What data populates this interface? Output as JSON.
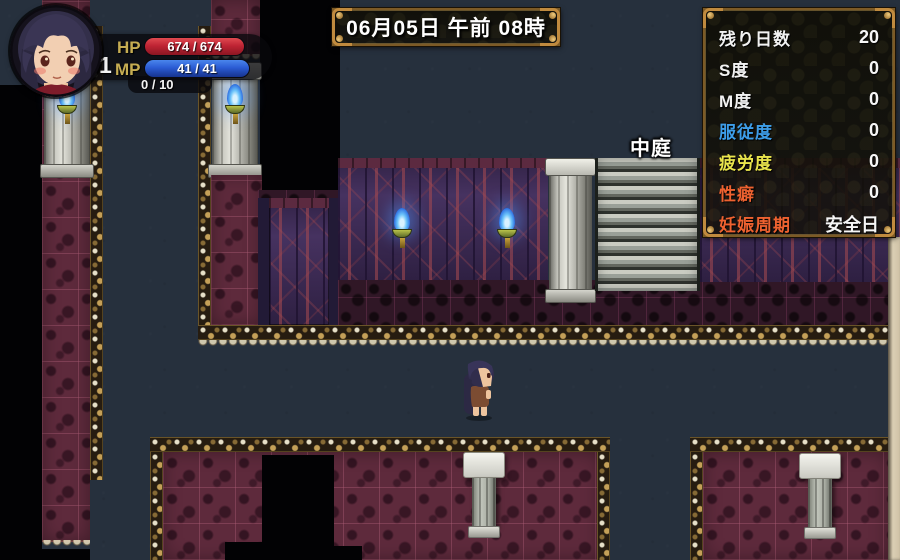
{
  "hud": {
    "hp_label": "HP",
    "hp_value": "674 / 674",
    "mp_label": "MP",
    "mp_value": "41 / 41",
    "lv_label": "LV",
    "lv_value": "1",
    "exp_label": "EXP",
    "exp_value": "0 / 10"
  },
  "time_banner": {
    "text": "06月05日 午前 08時"
  },
  "stats_panel": {
    "rows": [
      {
        "label": "残り日数",
        "value": "20",
        "color": "#f2f2f2"
      },
      {
        "label": "S度",
        "value": "0",
        "color": "#f2f2f2"
      },
      {
        "label": "M度",
        "value": "0",
        "color": "#f2f2f2"
      },
      {
        "label": "服従度",
        "value": "0",
        "color": "#3d9de8"
      },
      {
        "label": "疲労度",
        "value": "0",
        "color": "#e9e44c"
      },
      {
        "label": "性癖",
        "value": "0",
        "color": "#ee6230"
      },
      {
        "label": "妊娠周期",
        "value": "安全日",
        "color": "#ee6230"
      }
    ]
  },
  "map": {
    "location_label": "中庭"
  },
  "theme": {
    "hp_bar_color": "#bf2434",
    "mp_bar_color": "#2b5cd4",
    "torch_flame_color": "#47a8f8",
    "trim_gold_color": "#c9ab67",
    "carpet_color": "#5e2a3c",
    "wall_color": "#463260"
  }
}
